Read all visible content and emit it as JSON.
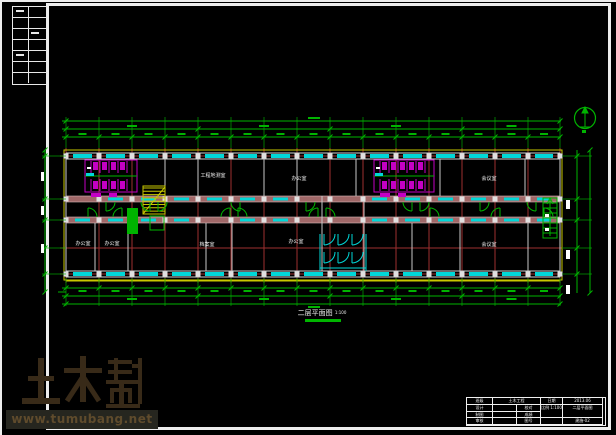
{
  "watermark": {
    "logo_text": "土木帮",
    "site_url": "www.tumubang.net"
  },
  "drawing": {
    "title": "二层平面图",
    "scale": "1:100",
    "room_labels": [
      "工程地测室",
      "办公室",
      "会议室",
      "办公室",
      "办公室",
      "档案室",
      "办公室",
      "会议室"
    ]
  },
  "title_block": {
    "r1c1": "班级",
    "r1c2": "土木工程",
    "r1c3": "日期",
    "r1c4": "2013.06",
    "a1": "设计",
    "a2": "制图",
    "a3": "审核",
    "c1": "校对",
    "c2": "成绩",
    "c3": "图号",
    "scale_cell": "比例 1:100",
    "name_cell": "二层平面图",
    "no_cell": "建施-02"
  },
  "colors": {
    "dim_green": "#00b400",
    "grid_red": "#9e2f2f",
    "wall_rose": "#a06868",
    "wall_edge": "#d8b8b8",
    "window_cyan": "#00d8d8",
    "magenta": "#c400c4",
    "yellow": "#c8c800",
    "line_gray": "#cfcfcf",
    "column_gray": "#e0e0e0",
    "watermark_brown": "#382a18",
    "white": "#f0f0f0"
  }
}
